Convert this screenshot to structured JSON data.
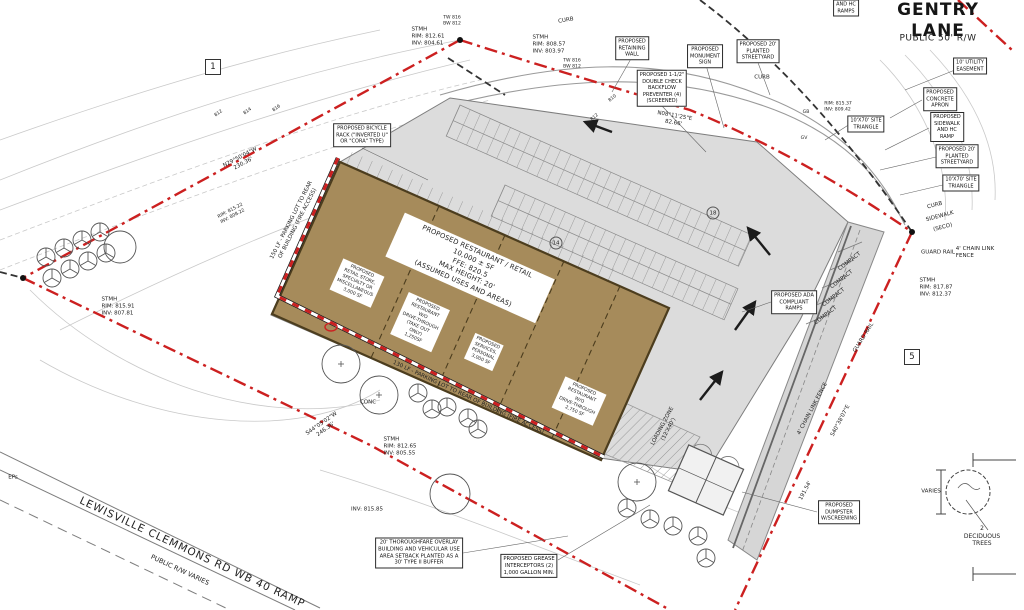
{
  "street": {
    "name": "GENTRY LANE",
    "rw": "PUBLIC 50' R/W"
  },
  "building": {
    "main_label": "PROPOSED RESTAURANT / RETAIL\n10,000 ± SF\nFFE: 820.5\nMAX HEIGHT: 20'\n(ASSUMED USES AND AREAS)",
    "units": [
      {
        "text": "PROPOSED\nRETAIL STORE,\nSPECIALTY OR\nMISCELLANEOUS\n3,000 SF"
      },
      {
        "text": "PROPOSED\nRESTAURANT\nW/O\nDRIVE-THROUGH\n(TAKE OUT\nONLY)\n1,250SF"
      },
      {
        "text": "PROPOSED\nSERVICES,\nPERSONAL\n3,000 SF"
      },
      {
        "text": "PROPOSED\nRESTAURANT\nW/O\nDRIVE-THROUGH\n2,750 SF"
      }
    ]
  },
  "callouts": [
    {
      "text": "PROPOSED\nRETAINING\nWALL"
    },
    {
      "text": "PROPOSED\nMONUMENT\nSIGN"
    },
    {
      "text": "PROPOSED 20'\nPLANTED\nSTREETYARD"
    },
    {
      "text": "PROPOSED 1-1/2\"\nDOUBLE CHECK\nBACKFLOW\nPREVENTER (4)\n(SCREENED)"
    },
    {
      "text": "10' UTILITY\nEASEMENT"
    },
    {
      "text": "PROPOSED\nCONCRETE\nAPRON"
    },
    {
      "text": "PROPOSED\nSIDEWALK\nAND HC\nRAMP"
    },
    {
      "text": "PROPOSED 20'\nPLANTED\nSTREETYARD"
    },
    {
      "text": "10'X70' SITE\nTRIANGLE"
    },
    {
      "text": "10'X70' SITE\nTRIANGLE"
    },
    {
      "text": "PROPOSED BICYCLE\nRACK (\"INVERTED U\"\nOR \"CORA\" TYPE)"
    },
    {
      "text": "PROPOSED ADA\nCOMPLIANT\nRAMPS"
    },
    {
      "text": "PROPOSED\nDUMPSTER\nW/SCREENING"
    },
    {
      "text": "20' THOROUGHFARE OVERLAY\nBUILDING AND VEHICULAR USE\nAREA SETBACK PLANTED AS A\n30' TYPE II BUFFER"
    },
    {
      "text": "PROPOSED GREASE\nINTERCEPTORS (2)\n1,000 GALLON MIN."
    },
    {
      "text": "AND HC\nRAMPS"
    }
  ],
  "labels": [
    {
      "text": "GENTRY LANE"
    },
    {
      "text": "PUBLIC 50' R/W"
    },
    {
      "text": "CURB"
    },
    {
      "text": "STMH\nRIM: 808.57\nINV: 803.97"
    },
    {
      "text": "STMH\nRIM: 812.61\nINV: 804.61"
    },
    {
      "text": "TW 816\nBW 812"
    },
    {
      "text": "TW 816\nBW 812"
    },
    {
      "text": "N29°50'04\"W\n230.36'"
    },
    {
      "text": "N08°11'25\"E\n82.66'"
    },
    {
      "text": "150 LF - PARKING LOT TO REAR\nOF BUILDING (FIRE ACCESS)"
    },
    {
      "text": "130 LF - PARKING LOT TO REAR OF BUILDING (FIRE ACCESS)"
    },
    {
      "text": "STMH\nRIM: 815.91\nINV: 807.81"
    },
    {
      "text": "STMH\nRIM: 812.65\nINV: 805.55"
    },
    {
      "text": "STMH\nRIM: 817.87\nINV: 812.37"
    },
    {
      "text": "CONC"
    },
    {
      "text": "INV: 815.85"
    },
    {
      "text": "EPs"
    },
    {
      "text": "LEWISVILLE CLEMMONS RD WB 40 RAMP"
    },
    {
      "text": "PUBLIC R/W VARIES"
    },
    {
      "text": "CURB"
    },
    {
      "text": "SIDEWALK"
    },
    {
      "text": "(SECO)"
    },
    {
      "text": "GUARD RAIL"
    },
    {
      "text": "GUARD RAIL"
    },
    {
      "text": "4' CHAIN LINK\nFENCE"
    },
    {
      "text": "4' CHAIN LINK FENCE"
    },
    {
      "text": "191.54'"
    },
    {
      "text": "S40°38'07\"E"
    },
    {
      "text": "COMPACT"
    },
    {
      "text": "COMPACT"
    },
    {
      "text": "COMPACT"
    },
    {
      "text": "COMPACT"
    },
    {
      "text": "CURB"
    },
    {
      "text": "RIM: 815.37\nINV: 809.42"
    },
    {
      "text": "RIM: 815.22\nINV: 808.22"
    },
    {
      "text": "LOADING ZONE\n(12'X40')"
    },
    {
      "text": "S44°05'02\"W\n246.36'"
    },
    {
      "text": "812"
    },
    {
      "text": "814"
    },
    {
      "text": "816"
    },
    {
      "text": "810"
    },
    {
      "text": "812"
    },
    {
      "text": "GB"
    },
    {
      "text": "GV"
    }
  ],
  "markers": {
    "m1": "1",
    "m5": "5"
  },
  "stall_numbers": {
    "c14": "14",
    "c18": "18"
  },
  "legend": {
    "varies": "VARIES",
    "trees": "2 DECIDUOUS TREES"
  },
  "colors": {
    "boundary_red": "#cc2020",
    "building_tan": "#a68b5b",
    "lot_gray": "#dcdcdc"
  }
}
